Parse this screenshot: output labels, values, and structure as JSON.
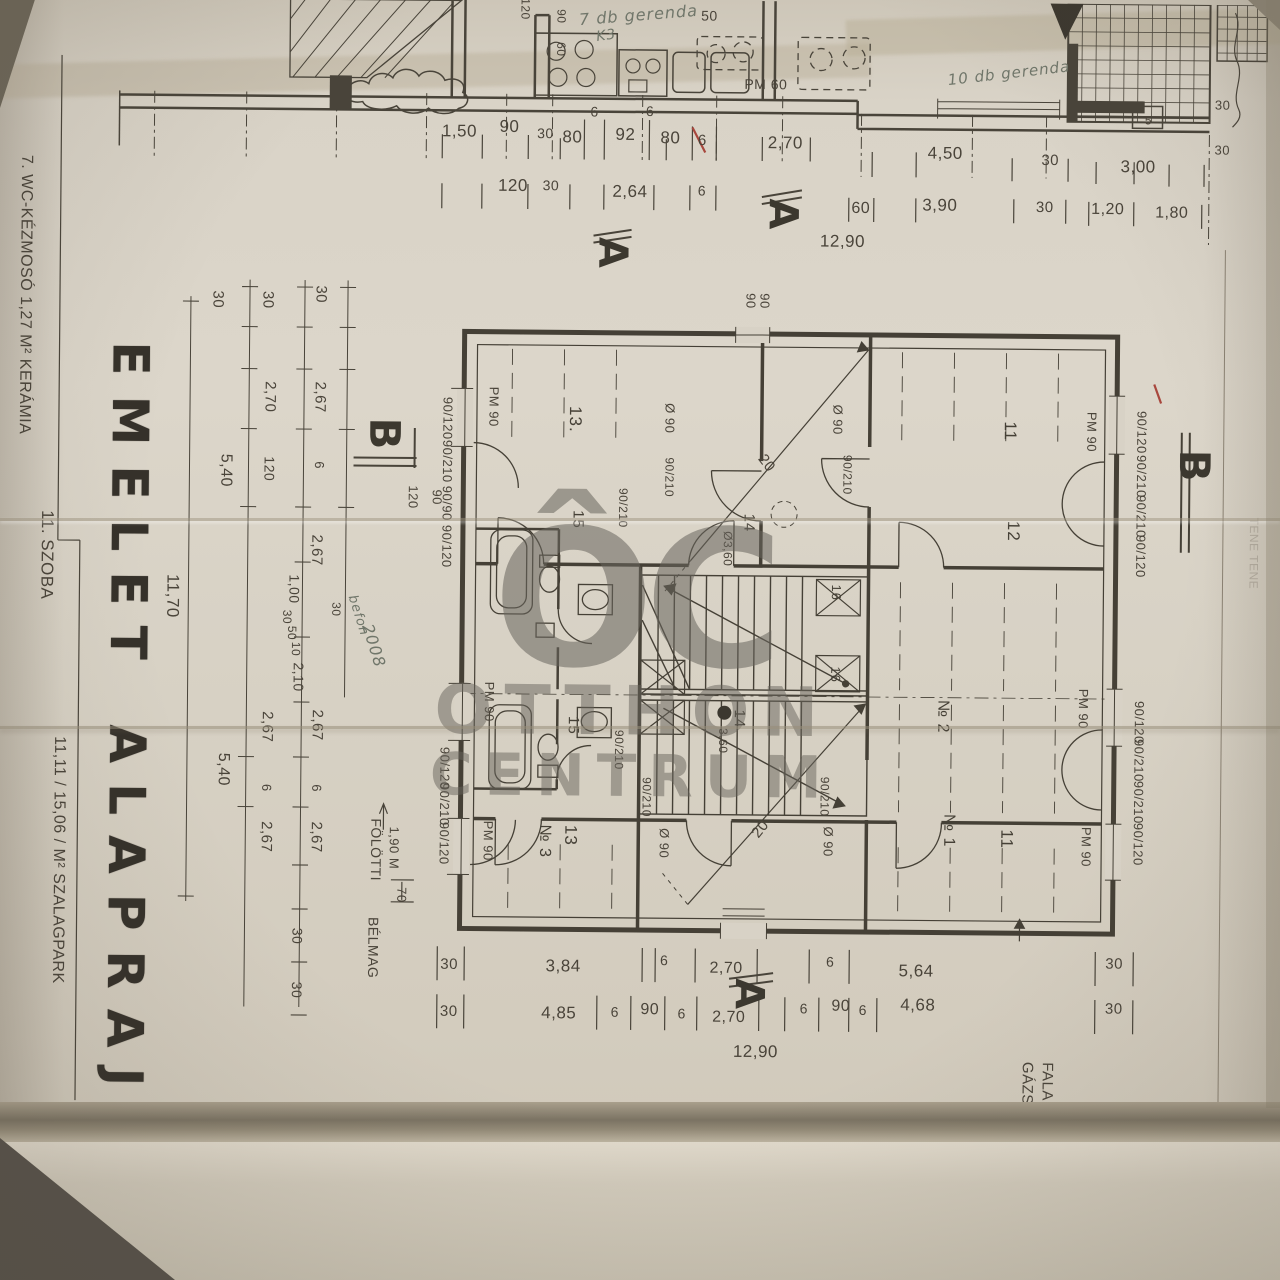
{
  "meta": {
    "description": "Photographed architectural blueprint page, Hungarian upper-floor plan with Otthon Centrum watermark",
    "language": "Hungarian"
  },
  "palette": {
    "paper": "#d7d1c4",
    "ink": "#49443a",
    "stamp_ink": "#3c382f",
    "handwriting": "#70766a",
    "watermark": "rgba(104,100,92,0.5)",
    "red_mark": "#a8473d",
    "fold_shadow": "#7b7363"
  },
  "title": {
    "line1": "EMELET",
    "line2": "ALAPRAJZ"
  },
  "watermark": {
    "logo": "ÔC",
    "name_top": "OTTHON",
    "name_bottom": "CENTRUM"
  },
  "side_table": {
    "row1": "7.  WC-KÉZMOSÓ    1,27  M²   KERÁMIA",
    "row2": "11.  SZOBA    11,11 / 15,06 /  M²   SZALAGPARK"
  },
  "section_markers": [
    "A",
    "B",
    "B-B"
  ],
  "handwritten_notes": [
    "7 db gerenda",
    "K3",
    "10 db gerenda",
    "befon 2008",
    "ÉNK -1,0"
  ],
  "totals": {
    "overall_width": "12,90",
    "overall_height": "11,70"
  },
  "labels": [
    {
      "t": "1,50",
      "x": 455,
      "y": 133,
      "s": 17
    },
    {
      "t": "90",
      "x": 505,
      "y": 128,
      "s": 17
    },
    {
      "t": "30",
      "x": 541,
      "y": 134,
      "s": 14
    },
    {
      "t": "80",
      "x": 568,
      "y": 138,
      "s": 17
    },
    {
      "t": "6",
      "x": 590,
      "y": 112,
      "s": 14
    },
    {
      "t": "92",
      "x": 621,
      "y": 135,
      "s": 17
    },
    {
      "t": "6·",
      "x": 648,
      "y": 111,
      "s": 14
    },
    {
      "t": "80",
      "x": 666,
      "y": 138,
      "s": 17
    },
    {
      "t": "6",
      "x": 698,
      "y": 140,
      "s": 15
    },
    {
      "t": "2,70",
      "x": 781,
      "y": 142,
      "s": 17
    },
    {
      "t": "4,50",
      "x": 941,
      "y": 151,
      "s": 17
    },
    {
      "t": "30",
      "x": 1046,
      "y": 157,
      "s": 15
    },
    {
      "t": "3,00",
      "x": 1134,
      "y": 163,
      "s": 17
    },
    {
      "t": "120",
      "x": 509,
      "y": 187,
      "s": 17
    },
    {
      "t": "30",
      "x": 547,
      "y": 186,
      "s": 14
    },
    {
      "t": "2,64",
      "x": 626,
      "y": 192,
      "s": 17
    },
    {
      "t": "6",
      "x": 698,
      "y": 190,
      "s": 14
    },
    {
      "t": "60",
      "x": 857,
      "y": 207,
      "s": 16
    },
    {
      "t": "3,90",
      "x": 936,
      "y": 203,
      "s": 17
    },
    {
      "t": "30",
      "x": 1041,
      "y": 204,
      "s": 15
    },
    {
      "t": "1,20",
      "x": 1104,
      "y": 206,
      "s": 16
    },
    {
      "t": "1,80",
      "x": 1168,
      "y": 209,
      "s": 16
    },
    {
      "t": "12,90",
      "x": 839,
      "y": 240,
      "s": 17
    },
    {
      "t": "PM 60",
      "x": 761,
      "y": 83,
      "s": 14
    },
    {
      "t": "50",
      "x": 704,
      "y": 15,
      "s": 14
    },
    {
      "t": "90",
      "x": 556,
      "y": 17,
      "r": 90,
      "s": 12
    },
    {
      "t": "60",
      "x": 556,
      "y": 50,
      "r": 90,
      "s": 12
    },
    {
      "t": "120",
      "x": 520,
      "y": 10,
      "r": 90,
      "s": 12
    },
    {
      "t": "5",
      "x": 1144,
      "y": 116,
      "s": 12
    },
    {
      "t": "30",
      "x": 1218,
      "y": 100,
      "s": 13
    },
    {
      "t": "30",
      "x": 1218,
      "y": 145,
      "s": 13
    },
    {
      "t": "7 db gerenda",
      "x": 633,
      "y": 15,
      "r": -5,
      "s": 16,
      "c": "hand"
    },
    {
      "t": "K3",
      "x": 601,
      "y": 36,
      "r": -8,
      "s": 14,
      "c": "hand"
    },
    {
      "t": "10 db gerenda",
      "x": 1004,
      "y": 70,
      "r": -7,
      "s": 15,
      "c": "hand"
    },
    {
      "t": "A",
      "x": 779,
      "y": 213,
      "r": 90,
      "s": 40,
      "c": "stamp",
      "n": "section-marker-a-top"
    },
    {
      "t": "A",
      "x": 609,
      "y": 253,
      "r": 90,
      "s": 40,
      "c": "stamp",
      "n": "section-marker-a-top2"
    },
    {
      "t": "A",
      "x": 752,
      "y": 993,
      "r": 90,
      "s": 40,
      "c": "stamp",
      "n": "section-marker-a-bottom"
    },
    {
      "t": "B",
      "x": 383,
      "y": 436,
      "r": 90,
      "s": 42,
      "c": "stamp",
      "n": "section-marker-b-left"
    },
    {
      "t": "B",
      "x": 1193,
      "y": 461,
      "r": 90,
      "s": 42,
      "c": "stamp",
      "n": "section-marker-b-right"
    },
    {
      "t": "B-B",
      "x": 120,
      "y": 1232,
      "r": 90,
      "s": 34,
      "c": "stamp",
      "n": "section-label-bb"
    },
    {
      "t": "EMELET",
      "x": 128,
      "y": 515,
      "r": 90,
      "s": 50,
      "c": "title",
      "n": "plan-title-line1"
    },
    {
      "t": "ALAPRAJZ",
      "x": 128,
      "y": 948,
      "r": 90,
      "s": 50,
      "c": "title",
      "n": "plan-title-line2"
    },
    {
      "t": "7.  WC-KÉZMOSÓ   1,27  M²  KERÁMIA",
      "x": 22,
      "y": 300,
      "r": 90,
      "s": 16,
      "n": "room-table-row1"
    },
    {
      "t": "11.  SZOBA",
      "x": 46,
      "y": 560,
      "r": 90,
      "s": 17,
      "n": "room-table-row2a"
    },
    {
      "t": "11,11 / 15,06 /   M²   SZALAGPARK",
      "x": 60,
      "y": 865,
      "r": 90,
      "s": 16,
      "n": "room-table-row2b"
    },
    {
      "t": "30",
      "x": 215,
      "y": 303,
      "r": 90,
      "s": 15
    },
    {
      "t": "30",
      "x": 265,
      "y": 303,
      "r": 90,
      "s": 15
    },
    {
      "t": "30",
      "x": 318,
      "y": 297,
      "r": 90,
      "s": 15
    },
    {
      "t": "2,67",
      "x": 318,
      "y": 400,
      "r": 90,
      "s": 15
    },
    {
      "t": "2,70",
      "x": 268,
      "y": 400,
      "r": 90,
      "s": 15
    },
    {
      "t": "6",
      "x": 318,
      "y": 468,
      "r": 90,
      "s": 13
    },
    {
      "t": "120",
      "x": 268,
      "y": 472,
      "r": 90,
      "s": 14
    },
    {
      "t": "5,40",
      "x": 224,
      "y": 474,
      "r": 90,
      "s": 16
    },
    {
      "t": "2,67",
      "x": 316,
      "y": 553,
      "r": 90,
      "s": 15
    },
    {
      "t": "1,00",
      "x": 294,
      "y": 592,
      "r": 90,
      "s": 14
    },
    {
      "t": "30",
      "x": 287,
      "y": 620,
      "r": 90,
      "s": 12
    },
    {
      "t": "50",
      "x": 292,
      "y": 636,
      "r": 90,
      "s": 12
    },
    {
      "t": "10",
      "x": 296,
      "y": 652,
      "r": 90,
      "s": 12
    },
    {
      "t": "2,10",
      "x": 299,
      "y": 680,
      "r": 90,
      "s": 14
    },
    {
      "t": "30",
      "x": 336,
      "y": 612,
      "r": 90,
      "s": 12
    },
    {
      "t": "2,67",
      "x": 318,
      "y": 728,
      "r": 90,
      "s": 15
    },
    {
      "t": "2,67",
      "x": 268,
      "y": 730,
      "r": 90,
      "s": 15
    },
    {
      "t": "6",
      "x": 318,
      "y": 791,
      "r": 90,
      "s": 13
    },
    {
      "t": "6",
      "x": 268,
      "y": 791,
      "r": 90,
      "s": 13
    },
    {
      "t": "2,67",
      "x": 318,
      "y": 840,
      "r": 90,
      "s": 15
    },
    {
      "t": "2,67",
      "x": 268,
      "y": 840,
      "r": 90,
      "s": 15
    },
    {
      "t": "5,40",
      "x": 224,
      "y": 773,
      "r": 90,
      "s": 16
    },
    {
      "t": "30",
      "x": 300,
      "y": 939,
      "r": 90,
      "s": 14
    },
    {
      "t": "30",
      "x": 300,
      "y": 993,
      "r": 90,
      "s": 14
    },
    {
      "t": "11,70",
      "x": 172,
      "y": 600,
      "r": 90,
      "s": 17
    },
    {
      "t": "120",
      "x": 412,
      "y": 499,
      "r": 90,
      "s": 13
    },
    {
      "t": "90",
      "x": 436,
      "y": 499,
      "r": 90,
      "s": 13
    },
    {
      "t": "befon",
      "x": 358,
      "y": 618,
      "r": 72,
      "s": 13,
      "c": "hand"
    },
    {
      "t": "2008",
      "x": 374,
      "y": 648,
      "r": 72,
      "s": 16,
      "c": "hand"
    },
    {
      "t": "PM 90",
      "x": 492,
      "y": 408,
      "r": 90,
      "s": 13
    },
    {
      "t": "PM 90",
      "x": 490,
      "y": 703,
      "r": 90,
      "s": 13
    },
    {
      "t": "PM 90",
      "x": 490,
      "y": 842,
      "r": 90,
      "s": 13
    },
    {
      "t": "PM 90",
      "x": 1090,
      "y": 428,
      "r": 90,
      "s": 13
    },
    {
      "t": "PM 90",
      "x": 1084,
      "y": 705,
      "r": 90,
      "s": 13
    },
    {
      "t": "PM 90",
      "x": 1088,
      "y": 843,
      "r": 90,
      "s": 13
    },
    {
      "t": "90/120",
      "x": 446,
      "y": 420,
      "r": 90,
      "s": 13
    },
    {
      "t": "90/210",
      "x": 446,
      "y": 463,
      "r": 90,
      "s": 13
    },
    {
      "t": "90/90",
      "x": 446,
      "y": 505,
      "r": 90,
      "s": 13
    },
    {
      "t": "90/120",
      "x": 446,
      "y": 548,
      "r": 90,
      "s": 13
    },
    {
      "t": "90/120",
      "x": 446,
      "y": 770,
      "r": 90,
      "s": 13
    },
    {
      "t": "90/210",
      "x": 446,
      "y": 806,
      "r": 90,
      "s": 13
    },
    {
      "t": "90/120",
      "x": 446,
      "y": 845,
      "r": 90,
      "s": 13
    },
    {
      "t": "90/120",
      "x": 1140,
      "y": 428,
      "r": 90,
      "s": 13
    },
    {
      "t": "90/210",
      "x": 1140,
      "y": 472,
      "r": 90,
      "s": 13
    },
    {
      "t": "90/210",
      "x": 1140,
      "y": 512,
      "r": 90,
      "s": 13
    },
    {
      "t": "90/120",
      "x": 1140,
      "y": 552,
      "r": 90,
      "s": 13
    },
    {
      "t": "90/120",
      "x": 1140,
      "y": 718,
      "r": 90,
      "s": 13
    },
    {
      "t": "90/210",
      "x": 1140,
      "y": 756,
      "r": 90,
      "s": 13
    },
    {
      "t": "90/210",
      "x": 1140,
      "y": 798,
      "r": 90,
      "s": 13
    },
    {
      "t": "90/120",
      "x": 1140,
      "y": 840,
      "r": 90,
      "s": 13
    },
    {
      "t": "90",
      "x": 748,
      "y": 300,
      "r": 90,
      "s": 13
    },
    {
      "t": "90",
      "x": 762,
      "y": 300,
      "r": 90,
      "s": 13
    },
    {
      "t": "Ø 90",
      "x": 668,
      "y": 418,
      "r": 90,
      "s": 13
    },
    {
      "t": "Ø 90",
      "x": 836,
      "y": 418,
      "r": 90,
      "s": 13
    },
    {
      "t": "90/210",
      "x": 668,
      "y": 477,
      "r": 90,
      "s": 12
    },
    {
      "t": "90/210",
      "x": 846,
      "y": 473,
      "r": 90,
      "s": 12
    },
    {
      "t": "90/210",
      "x": 622,
      "y": 508,
      "r": 90,
      "s": 12
    },
    {
      "t": "Ø 90",
      "x": 666,
      "y": 843,
      "r": 90,
      "s": 13
    },
    {
      "t": "Ø 90",
      "x": 830,
      "y": 840,
      "r": 90,
      "s": 13
    },
    {
      "t": "90/210",
      "x": 648,
      "y": 797,
      "r": 90,
      "s": 12
    },
    {
      "t": "90/210",
      "x": 826,
      "y": 795,
      "r": 90,
      "s": 12
    },
    {
      "t": "90/210",
      "x": 620,
      "y": 750,
      "r": 90,
      "s": 12
    },
    {
      "t": "13.",
      "x": 573,
      "y": 420,
      "r": 90,
      "s": 17,
      "c": "room"
    },
    {
      "t": "11",
      "x": 1008,
      "y": 428,
      "r": 90,
      "s": 17,
      "c": "room"
    },
    {
      "t": "12",
      "x": 1012,
      "y": 528,
      "r": 90,
      "s": 17,
      "c": "room"
    },
    {
      "t": "15",
      "x": 577,
      "y": 520,
      "r": 90,
      "s": 15,
      "c": "room"
    },
    {
      "t": "14",
      "x": 748,
      "y": 522,
      "r": 90,
      "s": 15,
      "c": "room"
    },
    {
      "t": "Ø3,60",
      "x": 727,
      "y": 548,
      "r": 90,
      "s": 12
    },
    {
      "t": "16",
      "x": 836,
      "y": 591,
      "r": 90,
      "s": 13,
      "c": "room"
    },
    {
      "t": "16",
      "x": 836,
      "y": 673,
      "r": 90,
      "s": 13,
      "c": "room"
    },
    {
      "t": "14",
      "x": 740,
      "y": 718,
      "r": 90,
      "s": 15,
      "c": "room"
    },
    {
      "t": "3,60",
      "x": 724,
      "y": 740,
      "r": 90,
      "s": 12
    },
    {
      "t": "15",
      "x": 574,
      "y": 726,
      "r": 90,
      "s": 15,
      "c": "room"
    },
    {
      "t": "13",
      "x": 572,
      "y": 836,
      "r": 90,
      "s": 17,
      "c": "room"
    },
    {
      "t": "№ 3",
      "x": 546,
      "y": 842,
      "r": 90,
      "s": 16,
      "c": "room"
    },
    {
      "t": "№ 2",
      "x": 943,
      "y": 714,
      "r": 90,
      "s": 16,
      "c": "room"
    },
    {
      "t": "№ 1",
      "x": 950,
      "y": 828,
      "r": 90,
      "s": 16,
      "c": "room"
    },
    {
      "t": "11",
      "x": 1008,
      "y": 836,
      "r": 90,
      "s": 17,
      "c": "room"
    },
    {
      "t": "20",
      "x": 765,
      "y": 462,
      "r": 52,
      "s": 15
    },
    {
      "t": "20",
      "x": 762,
      "y": 828,
      "r": -52,
      "s": 15
    },
    {
      "t": "30",
      "x": 452,
      "y": 966,
      "s": 15
    },
    {
      "t": "3,84",
      "x": 566,
      "y": 967,
      "s": 17
    },
    {
      "t": "6",
      "x": 667,
      "y": 960,
      "s": 14
    },
    {
      "t": "2,70",
      "x": 729,
      "y": 968,
      "s": 16
    },
    {
      "t": "6",
      "x": 833,
      "y": 960,
      "s": 14
    },
    {
      "t": "5,64",
      "x": 919,
      "y": 969,
      "s": 17
    },
    {
      "t": "30",
      "x": 1117,
      "y": 960,
      "s": 15
    },
    {
      "t": "30",
      "x": 452,
      "y": 1013,
      "s": 15
    },
    {
      "t": "4,85",
      "x": 562,
      "y": 1014,
      "s": 17
    },
    {
      "t": "6",
      "x": 618,
      "y": 1012,
      "s": 14
    },
    {
      "t": "90",
      "x": 653,
      "y": 1010,
      "s": 16
    },
    {
      "t": "6",
      "x": 685,
      "y": 1013,
      "s": 14
    },
    {
      "t": "2,70",
      "x": 732,
      "y": 1017,
      "s": 16
    },
    {
      "t": "6",
      "x": 807,
      "y": 1007,
      "s": 14
    },
    {
      "t": "90",
      "x": 844,
      "y": 1005,
      "s": 16
    },
    {
      "t": "6",
      "x": 866,
      "y": 1008,
      "s": 14
    },
    {
      "t": "4,68",
      "x": 921,
      "y": 1003,
      "s": 17
    },
    {
      "t": "30",
      "x": 1117,
      "y": 1005,
      "s": 15
    },
    {
      "t": "12,90",
      "x": 759,
      "y": 1051,
      "s": 17
    },
    {
      "t": "1,90 M",
      "x": 396,
      "y": 850,
      "r": 90,
      "s": 13
    },
    {
      "t": "FÖLÖTTI",
      "x": 378,
      "y": 852,
      "r": 90,
      "s": 14
    },
    {
      "t": "70",
      "x": 404,
      "y": 897,
      "r": 90,
      "s": 13
    },
    {
      "t": "BÉLMAG",
      "x": 376,
      "y": 950,
      "r": 90,
      "s": 14
    },
    {
      "t": "FALA",
      "x": 1051,
      "y": 1078,
      "r": 90,
      "s": 15
    },
    {
      "t": "GÁZS",
      "x": 1031,
      "y": 1080,
      "r": 90,
      "s": 15
    },
    {
      "t": "KÁT 700/50",
      "x": 1008,
      "y": 1182,
      "r": 90,
      "s": 15
    },
    {
      "t": "TENE TENE",
      "x": 1253,
      "y": 548,
      "r": 90,
      "s": 12,
      "c": "faint"
    },
    {
      "t": "3,00",
      "x": 262,
      "y": 1244,
      "r": 90,
      "s": 15
    },
    {
      "t": "ÉNK -1,0",
      "x": 432,
      "y": 1152,
      "r": 75,
      "s": 12,
      "c": "hand"
    },
    {
      "t": "TER",
      "x": 470,
      "y": 1270,
      "r": 90,
      "s": 12
    },
    {
      "t": "+3,0",
      "x": 581,
      "y": 1268,
      "r": 90,
      "s": 12
    },
    {
      "t": "7",
      "x": 657,
      "y": 1272,
      "r": 90,
      "s": 13
    },
    {
      "t": "3,00",
      "x": 1266,
      "y": 1247,
      "r": 90,
      "s": 13
    },
    {
      "t": "ÔC",
      "x": 633,
      "y": 600,
      "s": 190,
      "c": "wlogo",
      "n": "watermark-logo"
    },
    {
      "t": "OTTHON",
      "x": 633,
      "y": 712,
      "s": 68,
      "c": "water",
      "n": "watermark-name-top"
    },
    {
      "t": "CENTRUM",
      "x": 633,
      "y": 776,
      "s": 58,
      "c": "water",
      "n": "watermark-name-bottom"
    }
  ]
}
